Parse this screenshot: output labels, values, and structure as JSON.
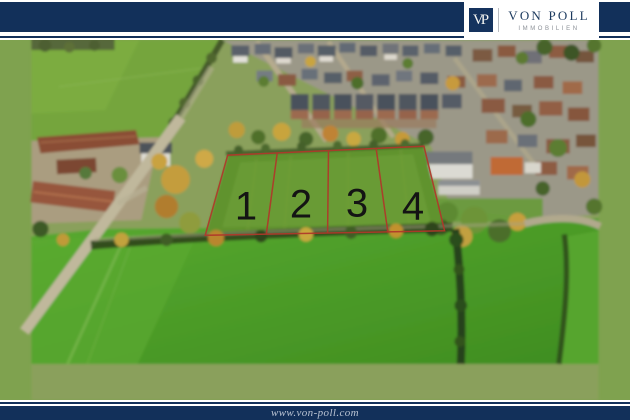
{
  "header": {
    "logo": {
      "monogram": "VP",
      "name": "VON POLL",
      "subtitle": "IMMOBILIEN"
    }
  },
  "overlay": {
    "description": "aerial photo of building land divided into four numbered plots",
    "plots": [
      {
        "label": "1"
      },
      {
        "label": "2"
      },
      {
        "label": "3"
      },
      {
        "label": "4"
      }
    ]
  },
  "footer": {
    "url": "www.von-poll.com"
  },
  "colors": {
    "brand_navy": "#12305a",
    "boundary_red": "#b0382a",
    "plot_number_color": "#141414",
    "footer_text": "#b9c3d3"
  }
}
